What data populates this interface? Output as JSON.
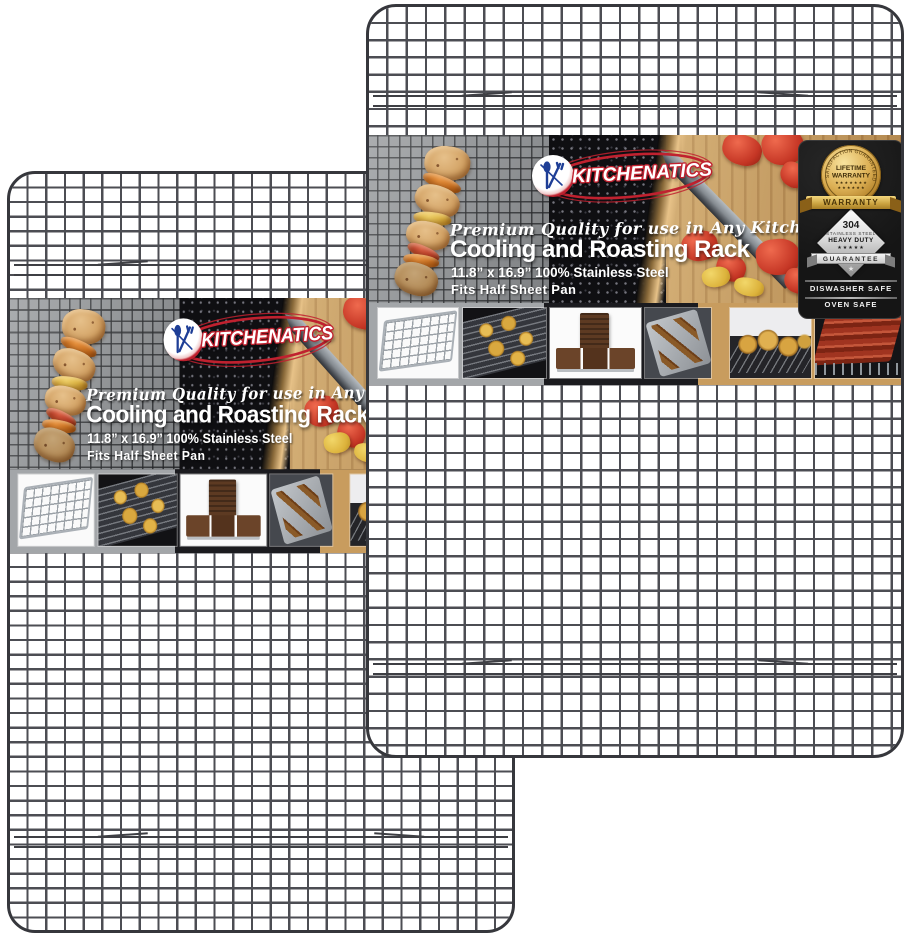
{
  "product_image": {
    "brand": "KITCHENATICS",
    "tagline": "Premium Quality for use in Any Kitchen",
    "title": "Cooling and Roasting Rack",
    "size_line": "11.8” x 16.9” 100% Stainless Steel",
    "fits_line": "Fits Half Sheet Pan",
    "seal": {
      "arc": "SATISFACTION GUARANTEED",
      "line1": "LIFETIME",
      "line2": "WARRANTY",
      "stars_row1": "★ ★ ★ ★ ★ ★ ★",
      "stars_row2": "★ ★ ★ ★ ★ ★",
      "ribbon": "WARRANTY"
    },
    "spec_diamond": {
      "number": "304",
      "material": "STAINLESS STEEL",
      "grade": "HEAVY DUTY",
      "stars": "★★★★★",
      "ribbon": "GUARANTEE",
      "star": "★"
    },
    "safety": {
      "dishwasher": "DISWASHER SAFE",
      "oven": "OVEN SAFE"
    },
    "thumbnails": [
      "cooling-rack",
      "cookies-on-rack",
      "chocolate-bars",
      "skewers-on-tray",
      "muffins-on-rack",
      "bacon-on-rack"
    ],
    "colors": {
      "brand_red": "#c0212f",
      "brand_blue": "#1e3e96",
      "gold": "#d4a547",
      "wire_gray": "#4c4d53",
      "panel_black": "#151515",
      "wood": "#c89c5e"
    }
  }
}
